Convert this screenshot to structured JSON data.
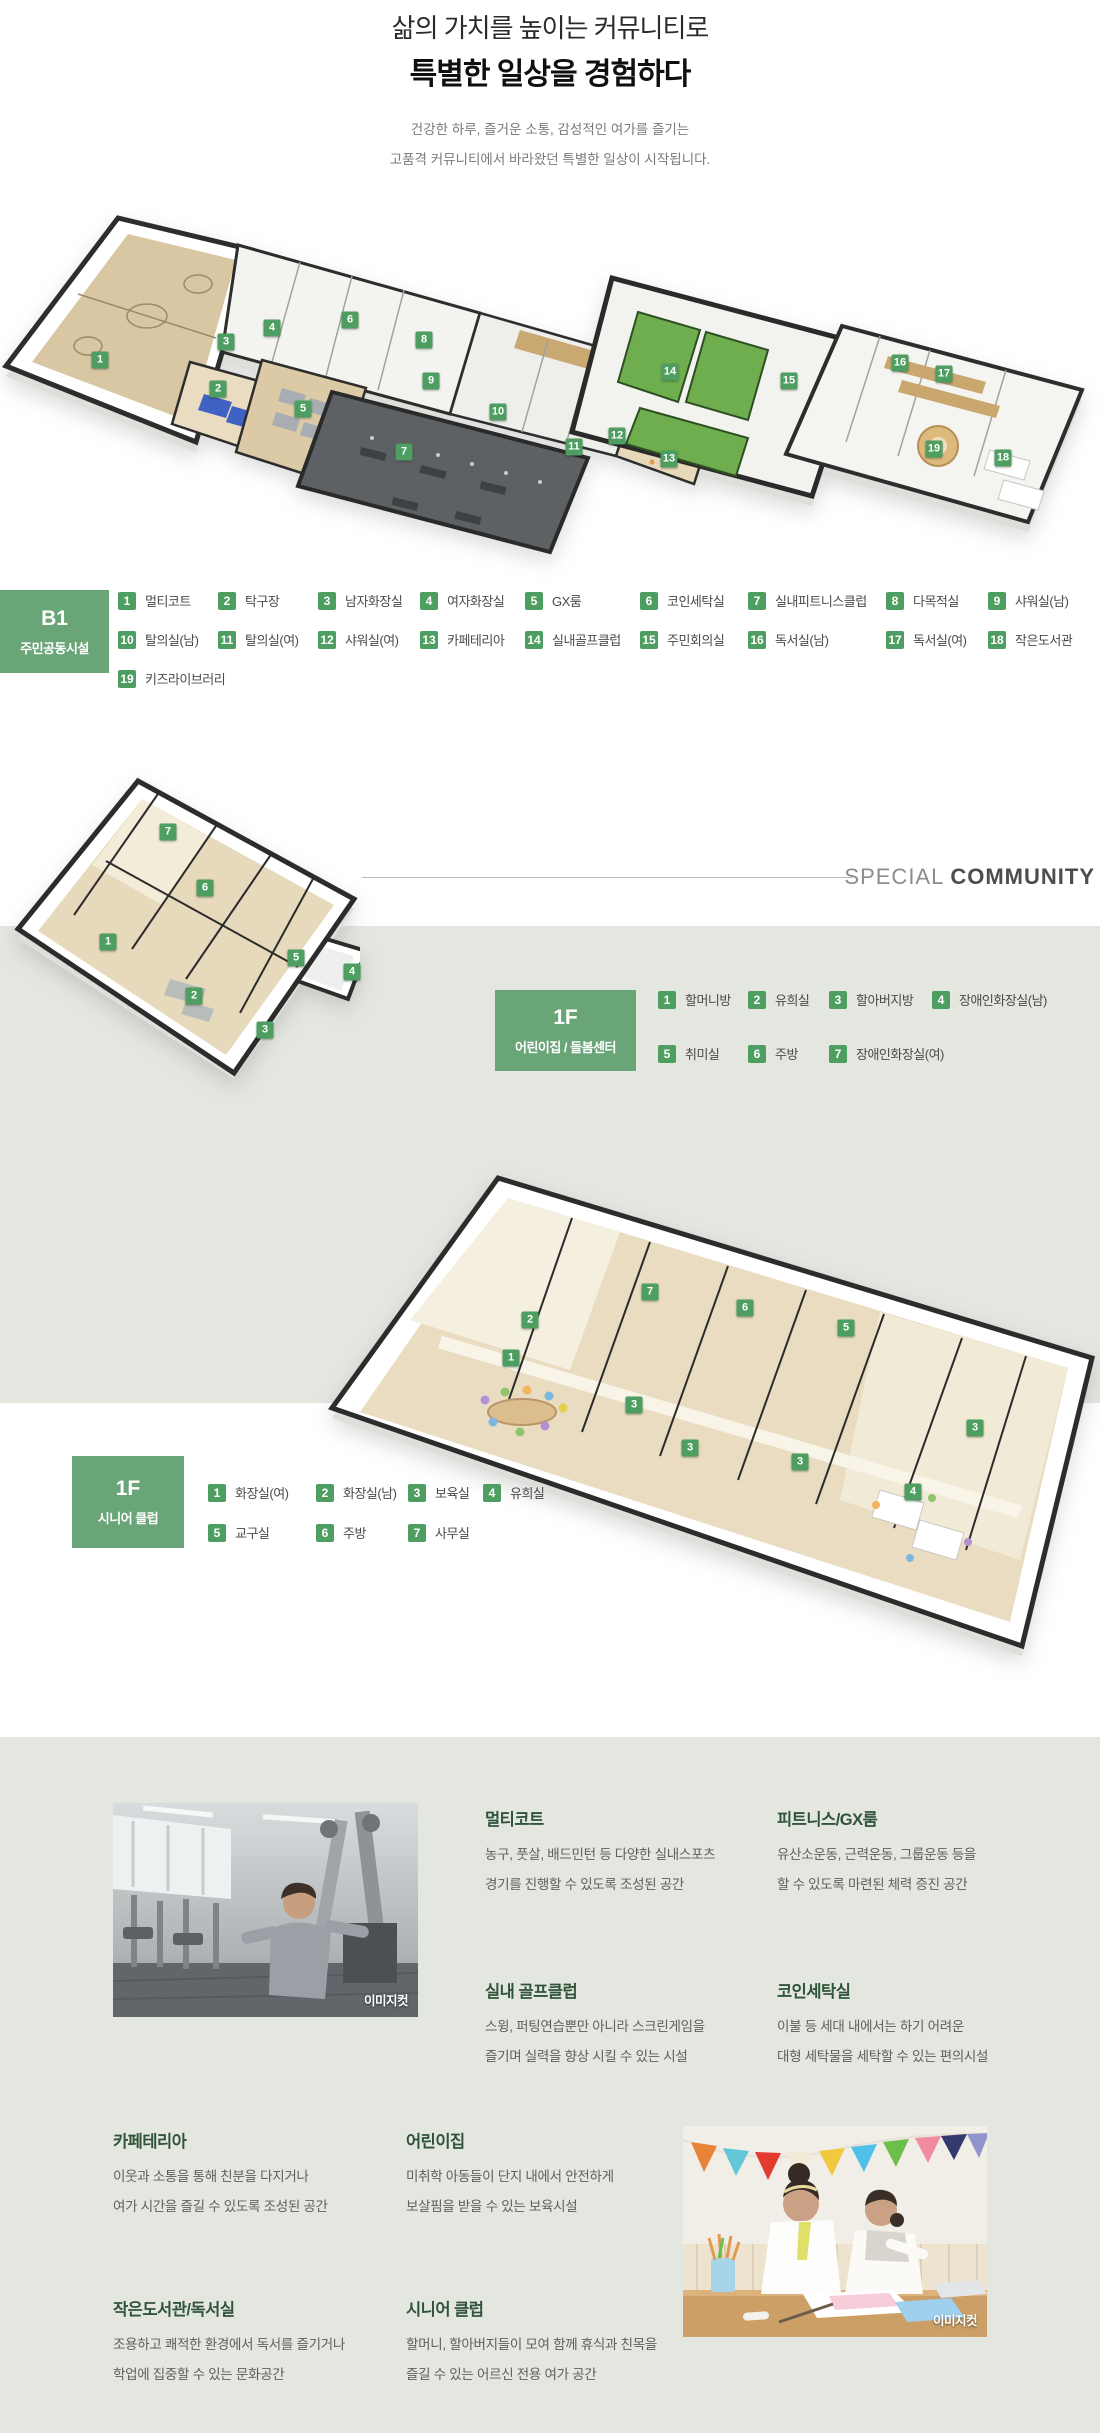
{
  "hero": {
    "title_line1": "삶의 가치를 높이는 커뮤니티로",
    "title_line2": "특별한 일상을 경험하다",
    "subtitle_line1": "건강한 하루, 즐거운 소통, 감성적인 여가를 즐기는",
    "subtitle_line2": "고품격 커뮤니티에서 바라왔던 특별한 일상이 시작됩니다."
  },
  "special_divider": {
    "light": "SPECIAL",
    "bold": "COMMUNITY"
  },
  "legend_sections": {
    "b1": {
      "floor": "B1",
      "title": "주민공동시설",
      "items": [
        {
          "num": "1",
          "label": "멀티코트"
        },
        {
          "num": "2",
          "label": "탁구장"
        },
        {
          "num": "3",
          "label": "남자화장실"
        },
        {
          "num": "4",
          "label": "여자화장실"
        },
        {
          "num": "5",
          "label": "GX룸"
        },
        {
          "num": "6",
          "label": "코인세탁실"
        },
        {
          "num": "7",
          "label": "실내피트니스클럽"
        },
        {
          "num": "8",
          "label": "다목적실"
        },
        {
          "num": "9",
          "label": "샤워실(남)"
        },
        {
          "num": "10",
          "label": "탈의실(남)"
        },
        {
          "num": "11",
          "label": "탈의실(여)"
        },
        {
          "num": "12",
          "label": "샤워실(여)"
        },
        {
          "num": "13",
          "label": "카페테리아"
        },
        {
          "num": "14",
          "label": "실내골프클럽"
        },
        {
          "num": "15",
          "label": "주민회의실"
        },
        {
          "num": "16",
          "label": "독서실(남)"
        },
        {
          "num": "17",
          "label": "독서실(여)"
        },
        {
          "num": "18",
          "label": "작은도서관"
        },
        {
          "num": "19",
          "label": "키즈라이브러리"
        }
      ]
    },
    "daycare": {
      "floor": "1F",
      "title": "어린이집 / 돌봄센터",
      "items": [
        {
          "num": "1",
          "label": "할머니방"
        },
        {
          "num": "2",
          "label": "유희실"
        },
        {
          "num": "3",
          "label": "할아버지방"
        },
        {
          "num": "4",
          "label": "장애인화장실(남)"
        },
        {
          "num": "5",
          "label": "취미실"
        },
        {
          "num": "6",
          "label": "주방"
        },
        {
          "num": "7",
          "label": "장애인화장실(여)"
        }
      ]
    },
    "senior": {
      "floor": "1F",
      "title": "시니어 클럽",
      "items": [
        {
          "num": "1",
          "label": "화장실(여)"
        },
        {
          "num": "2",
          "label": "화장실(남)"
        },
        {
          "num": "3",
          "label": "보육실"
        },
        {
          "num": "4",
          "label": "유희실"
        },
        {
          "num": "5",
          "label": "교구실"
        },
        {
          "num": "6",
          "label": "주방"
        },
        {
          "num": "7",
          "label": "사무실"
        }
      ]
    }
  },
  "features": [
    {
      "title": "멀티코트",
      "lines": [
        "농구, 풋살, 배드민턴 등 다양한 실내스포츠",
        "경기를 진행할 수 있도록 조성된 공간"
      ]
    },
    {
      "title": "피트니스/GX룸",
      "lines": [
        "유산소운동, 근력운동, 그룹운동 등을",
        "할 수 있도록 마련된 체력 증진 공간"
      ]
    },
    {
      "title": "실내 골프클럽",
      "lines": [
        "스윙, 퍼팅연습뿐만 아니라 스크린게임을",
        "즐기며 실력을 향상 시킬 수 있는 시설"
      ]
    },
    {
      "title": "코인세탁실",
      "lines": [
        "이불 등 세대 내에서는 하기 어려운",
        "대형 세탁물을 세탁할 수 있는 편의시설"
      ]
    },
    {
      "title": "카페테리아",
      "lines": [
        "이웃과 소통을 통해 친분을 다지거나",
        "여가 시간을 즐길 수 있도록 조성된 공간"
      ]
    },
    {
      "title": "어린이집",
      "lines": [
        "미취학 아동들이 단지 내에서 안전하게",
        "보살핌을 받을 수 있는 보육시설"
      ]
    },
    {
      "title": "작은도서관/독서실",
      "lines": [
        "조용하고 쾌적한 환경에서 독서를 즐기거나",
        "학업에 집중할 수 있는 문화공간"
      ]
    },
    {
      "title": "시니어 클럽",
      "lines": [
        "할머니, 할아버지들이 모여 함께 휴식과 친목을",
        "즐길 수 있는 어르신 전용 여가 공간"
      ]
    }
  ],
  "photos": {
    "caption": "이미지컷"
  },
  "colors": {
    "accent_green": "#6aa578",
    "badge_green": "#4f9e61",
    "heading_green": "#2f5438",
    "band_gray": "#e4e6e0"
  }
}
